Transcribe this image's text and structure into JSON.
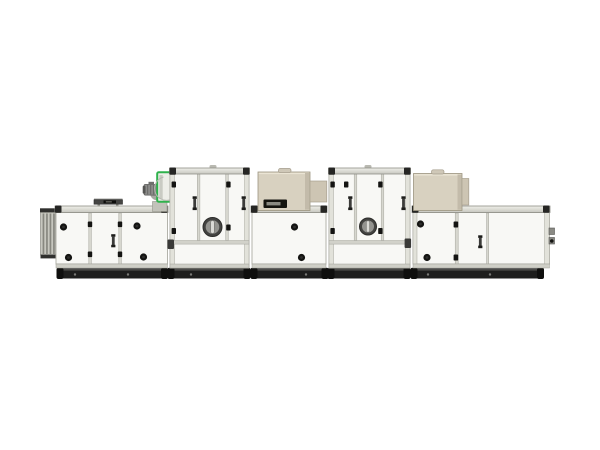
{
  "meta": {
    "description": "Side-view product photograph of a long modular industrial air handling / desiccant dehumidifier unit on a plain white background. No text is visible in the image.",
    "image_width_px": 600,
    "image_height_px": 450
  },
  "colors": {
    "background": "#ffffff",
    "panel_white": "#f8f8f5",
    "frame_gray": "#d6d6ce",
    "accent_green": "#2fb24c",
    "cassette_beige": "#d8d1c0",
    "cassette_flap": "#cdc5b3",
    "motor_gray": "#8c8c8a",
    "hardware_black": "#141412",
    "base_black": "#1e1e1d"
  },
  "unit": {
    "sections": [
      {
        "id": "intake-louver",
        "label": "vertical intake louver (left end)"
      },
      {
        "id": "left-access-module",
        "label": "low access module, 3 doors, 4 round locks, 1 handle, roof vent hood"
      },
      {
        "id": "supply-fan",
        "label": "blower housing outlined in green with gray motor, on pedestal"
      },
      {
        "id": "tall-module-1",
        "label": "tall 3-door module with round porthole sight glass"
      },
      {
        "id": "center-module",
        "label": "low center module with beige roof cassette (handle + vent slot)"
      },
      {
        "id": "tall-module-2",
        "label": "tall 3-door module with round porthole sight glass"
      },
      {
        "id": "right-module",
        "label": "low right end module with beige roof cassette and end latch"
      },
      {
        "id": "base-skids",
        "label": "five black base skid rails with feet"
      }
    ],
    "porthole_count": 2,
    "roof_cassette_count": 2
  }
}
